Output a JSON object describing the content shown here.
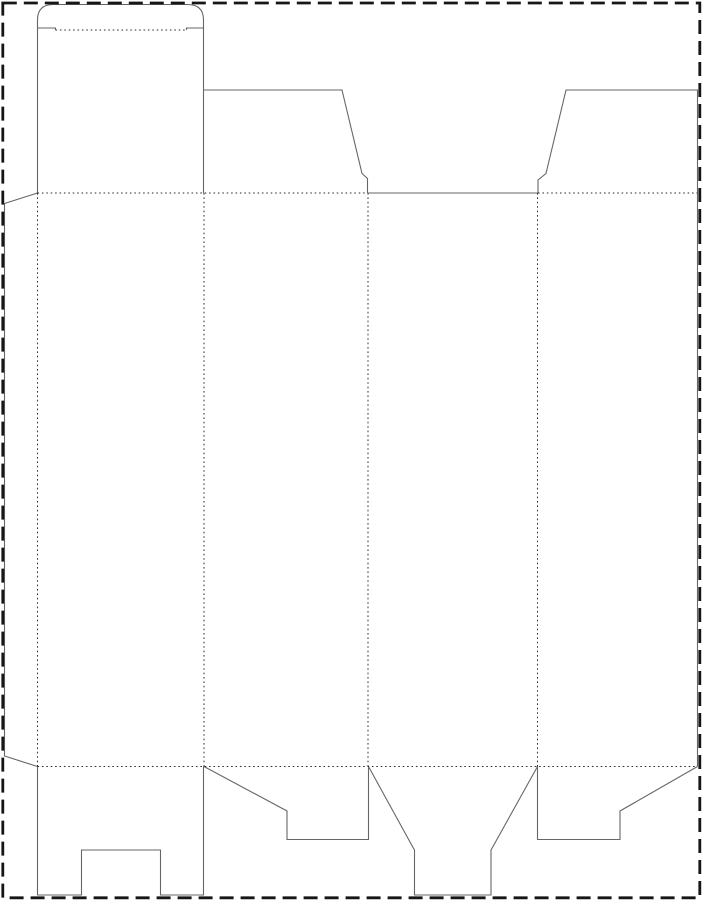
{
  "diagram": {
    "type": "packaging-dieline",
    "description": "Flat die-cut template (dieline) of a tuck-top folding carton with snap-lock bottom flaps, drawn on a white sheet surrounded by a dashed cut border. Solid gray lines are cut lines, fine dotted lines are fold/crease lines.",
    "canvas": {
      "width": 703,
      "height": 900,
      "background": "#ffffff"
    },
    "styles": {
      "cut_color": "#666666",
      "fold_color": "#2e2e2e",
      "border_color": "#161616",
      "cut_width": 1.1,
      "fold_width": 1,
      "border_width": 2.8,
      "border_dash": "14 7",
      "fold_dash": "1.6 2.8"
    },
    "page_border": {
      "x": 2.8,
      "y": 3,
      "width": 697,
      "height": 894.8
    },
    "cut_paths": [
      {
        "name": "glue-flap-outline",
        "d": "M 37.5 193 L 4.5 203.5 L 4.5 756 L 37.5 766.5"
      },
      {
        "name": "top-panel-tuck-outline",
        "d": "M 37.5 193 L 37.5 20 Q 37.5 4.5 53.5 4.5 L 187.5 4.5 Q 203.5 4.5 203.5 20 L 203.5 193"
      },
      {
        "name": "tuck-slit-left",
        "d": "M 37.5 28 L 55.5 28 L 55.5 30"
      },
      {
        "name": "tuck-slit-right",
        "d": "M 186.5 30 L 186.5 28 L 203.5 28"
      },
      {
        "name": "top-dust-flap-left",
        "d": "M 203.5 90 L 342 90 L 362 173.5 L 367.5 178.5 L 367.5 193"
      },
      {
        "name": "panel3-top-cut",
        "d": "M 367.5 193 L 538 193"
      },
      {
        "name": "top-dust-flap-right-and-side",
        "d": "M 538 193 L 538 180 L 546 173.5 L 566 90 L 697.5 90 L 697.5 766.5"
      },
      {
        "name": "bottom-lock-flap-notched",
        "d": "M 37.5 766.5 L 37.5 895 L 81.5 895 L 81.5 850 L 160.5 850 L 160.5 895 L 203.5 895 L 203.5 766.5"
      },
      {
        "name": "bottom-dust-flap-left",
        "d": "M 204 766.5 L 287 811 L 287 839.5 L 368.5 839.5 L 368.5 766.5"
      },
      {
        "name": "bottom-tongue-flap",
        "d": "M 368.5 766.5 L 412.5 846.5 L 414.5 850 L 414.5 895 L 491 895 L 491 850 L 493 846.5 L 537.5 766.5"
      },
      {
        "name": "bottom-dust-flap-right",
        "d": "M 537.5 766.5 L 537.5 839.5 L 620 839.5 L 620 811 L 697.5 766.5"
      }
    ],
    "fold_lines": [
      {
        "name": "tuck-flap-fold",
        "x1": 55.5,
        "y1": 30,
        "x2": 186.5,
        "y2": 30
      },
      {
        "name": "top-fold-left",
        "x1": 37.5,
        "y1": 193,
        "x2": 367.5,
        "y2": 193
      },
      {
        "name": "top-fold-right",
        "x1": 538,
        "y1": 193,
        "x2": 697.5,
        "y2": 193
      },
      {
        "name": "bottom-fold",
        "x1": 37.5,
        "y1": 766.5,
        "x2": 697.5,
        "y2": 766.5
      },
      {
        "name": "glue-flap-fold",
        "x1": 37.5,
        "y1": 193,
        "x2": 37.5,
        "y2": 766.5
      },
      {
        "name": "panel1-panel2-fold",
        "x1": 204,
        "y1": 193,
        "x2": 204,
        "y2": 766.5
      },
      {
        "name": "panel2-panel3-fold",
        "x1": 368,
        "y1": 193,
        "x2": 368,
        "y2": 766.5
      },
      {
        "name": "panel3-panel4-fold",
        "x1": 537.5,
        "y1": 193,
        "x2": 537.5,
        "y2": 766.5
      }
    ]
  }
}
